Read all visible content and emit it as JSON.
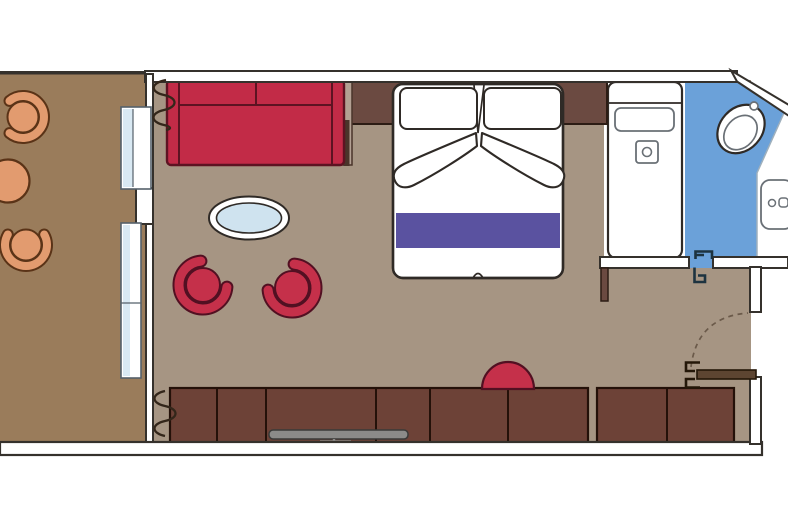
{
  "title": "Cruise cabin suite floor plan with balcony, living area, bedroom and bathroom",
  "colors": {
    "background": "#ffffff",
    "wall_fill": "#ffffff",
    "wall_stroke": "#35312c",
    "balcony_floor": "#9a7c5b",
    "room_floor": "#a69583",
    "sofa_red": "#c22b47",
    "sofa_outline": "#5d1322",
    "chair_red": "#c5304a",
    "chair_red_outline": "#521022",
    "balcony_chair_orange": "#e29b6f",
    "balcony_chair_outline": "#5a3317",
    "table_glass_blue": "#cfe3ef",
    "bed_white": "#ffffff",
    "bed_outline": "#2f2a26",
    "bed_runner_purple": "#5a52a0",
    "headboard_brown": "#6b4a41",
    "headboard_outline": "#2c1c14",
    "side_table_taupe": "#b3a093",
    "side_table_dark": "#4a342a",
    "cabinet_brown": "#6d4237",
    "cabinet_outline": "#241109",
    "bathroom_floor_blue": "#6ba1d9",
    "bath_edge_blue": "#3f6c9c",
    "glass_blue": "#d9e9f3",
    "glass_frame": "#55606a",
    "fixture_stroke": "#6a7076",
    "tv_gray": "#8b8b89",
    "door_brown": "#5d4531",
    "door_outline": "#241708",
    "door_symbol_dark": "#1d3340",
    "arc_dash": "#6b5a4a",
    "curtain_dark": "#33261a",
    "vanity_divider": "#9fb0bd"
  },
  "elements": [
    {
      "name": "balcony",
      "items": [
        "balcony-chair",
        "balcony-round-table",
        "balcony-chair",
        "balcony-railing"
      ]
    },
    {
      "name": "living-area",
      "items": [
        "sofa",
        "coffee-table",
        "tub-chair",
        "tub-chair",
        "curtain-symbol",
        "pouf",
        "wardrobe-row",
        "tv"
      ]
    },
    {
      "name": "bedroom",
      "items": [
        "double-bed",
        "pillow",
        "pillow",
        "folded-sheet",
        "bed-runner",
        "headboard",
        "nightstand"
      ]
    },
    {
      "name": "bathroom",
      "items": [
        "bathtub",
        "toilet",
        "washbasin",
        "bathroom-door-symbol"
      ]
    },
    {
      "name": "entry",
      "items": [
        "entry-door",
        "door-swing-arc",
        "hinge-bracket"
      ]
    },
    {
      "name": "openings",
      "items": [
        "sliding-glass-door",
        "sliding-glass-door",
        "diagonal-hull-wall"
      ]
    }
  ]
}
